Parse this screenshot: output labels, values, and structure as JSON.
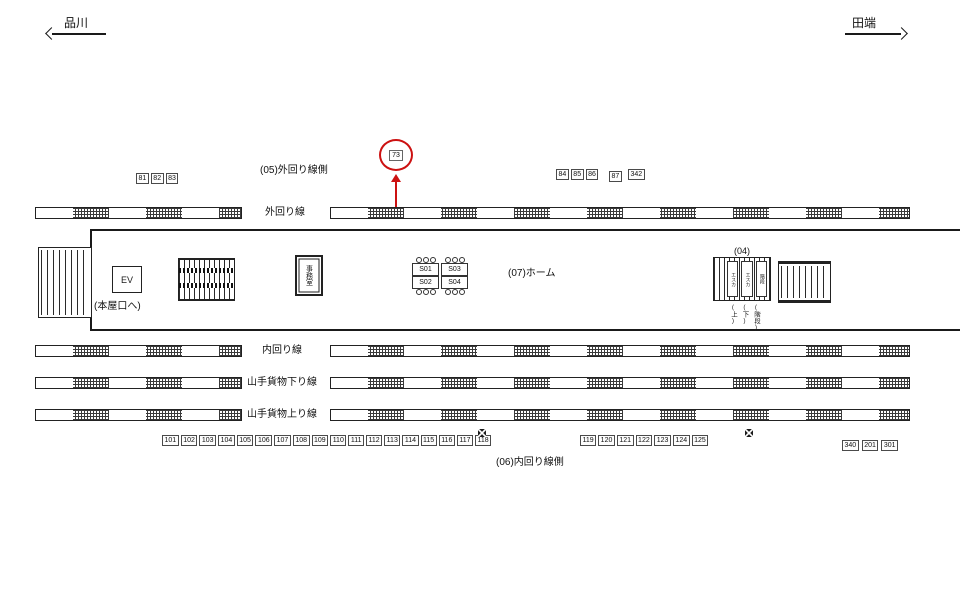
{
  "nav": {
    "left_station": "品川",
    "right_station": "田端"
  },
  "highlight": {
    "number": "73",
    "color": "#cc1111"
  },
  "labels": {
    "outer_line_side": "(05)外回り線側",
    "outer_line": "外回り線",
    "platform": "(07)ホーム",
    "loc_04": "(04)",
    "main_exit": "(本屋口へ)",
    "ev": "EV",
    "office": "事務室",
    "inner_line": "内回り線",
    "freight_down_line": "山手貨物下り線",
    "freight_up_line": "山手貨物上り線",
    "inner_line_side": "(06)内回り線側"
  },
  "ads": {
    "top_left": [
      "81",
      "82",
      "83"
    ],
    "top_right_a": [
      "84",
      "85",
      "86"
    ],
    "top_right_b": [
      "87"
    ],
    "top_right_c": [
      "342"
    ],
    "pillar_a": [
      "S01",
      "S02"
    ],
    "pillar_b": [
      "S03",
      "S04"
    ],
    "bottom_left": [
      "101",
      "102",
      "103",
      "104",
      "105",
      "106",
      "107",
      "108",
      "109",
      "110",
      "111",
      "112",
      "113",
      "114",
      "115",
      "116",
      "117",
      "118"
    ],
    "bottom_mid": [
      "119",
      "120",
      "121",
      "122",
      "123",
      "124",
      "125"
    ],
    "bottom_right": [
      "340",
      "201",
      "301"
    ]
  },
  "stairs04": {
    "strips": [
      "エスカ",
      "エスカ",
      "階段"
    ],
    "sub_labels": [
      "(上)",
      "(下)",
      "(階段)"
    ]
  }
}
